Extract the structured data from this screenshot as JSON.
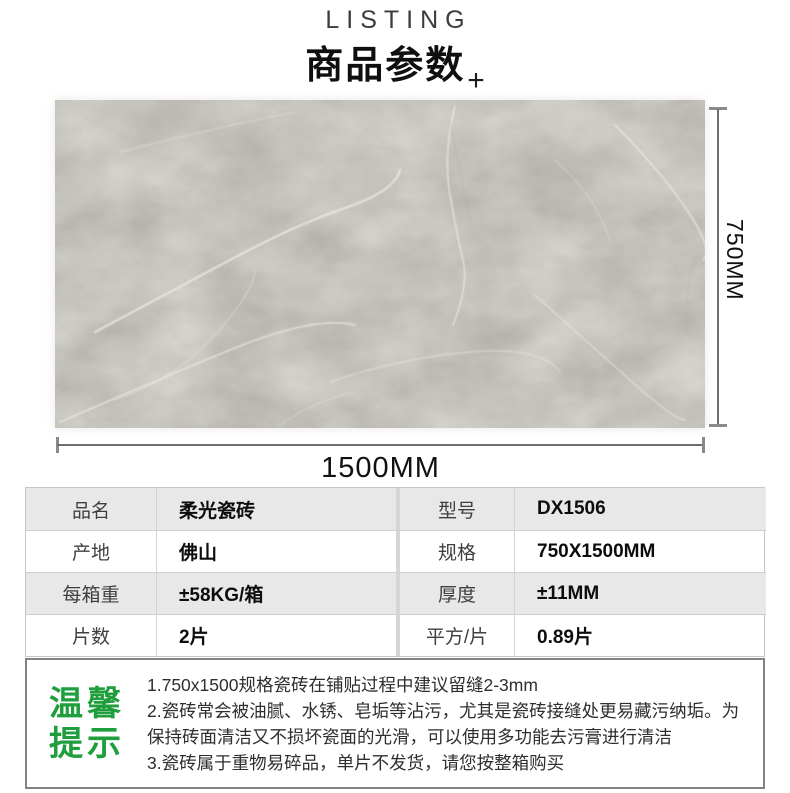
{
  "header": {
    "listing": "LISTING",
    "title": "商品参数",
    "plus": "+"
  },
  "dimensions": {
    "height_label": "750MM",
    "width_label": "1500MM"
  },
  "table": {
    "rows": [
      {
        "label1": "品名",
        "value1": "柔光瓷砖",
        "label2": "型号",
        "value2": "DX1506"
      },
      {
        "label1": "产地",
        "value1": "佛山",
        "label2": "规格",
        "value2": "750X1500MM"
      },
      {
        "label1": "每箱重",
        "value1": "±58KG/箱",
        "label2": "厚度",
        "value2": "±11MM"
      },
      {
        "label1": "片数",
        "value1": "2片",
        "label2": "平方/片",
        "value2": "0.89片"
      }
    ]
  },
  "tips": {
    "title_line1": "温馨",
    "title_line2": "提示",
    "items": [
      "1.750x1500规格瓷砖在铺贴过程中建议留缝2-3mm",
      "2.瓷砖常会被油腻、水锈、皂垢等沾污，尤其是瓷砖接缝处更易藏污纳垢。为保持砖面清洁又不损坏瓷面的光滑，可以使用多功能去污膏进行清洁",
      "3.瓷砖属于重物易碎品，单片不发货，请您按整箱购买"
    ]
  },
  "colors": {
    "accent_green": "#1e9e3c",
    "tile_gray": "#b4b1aa",
    "row_gray": "#e8e8e8"
  }
}
